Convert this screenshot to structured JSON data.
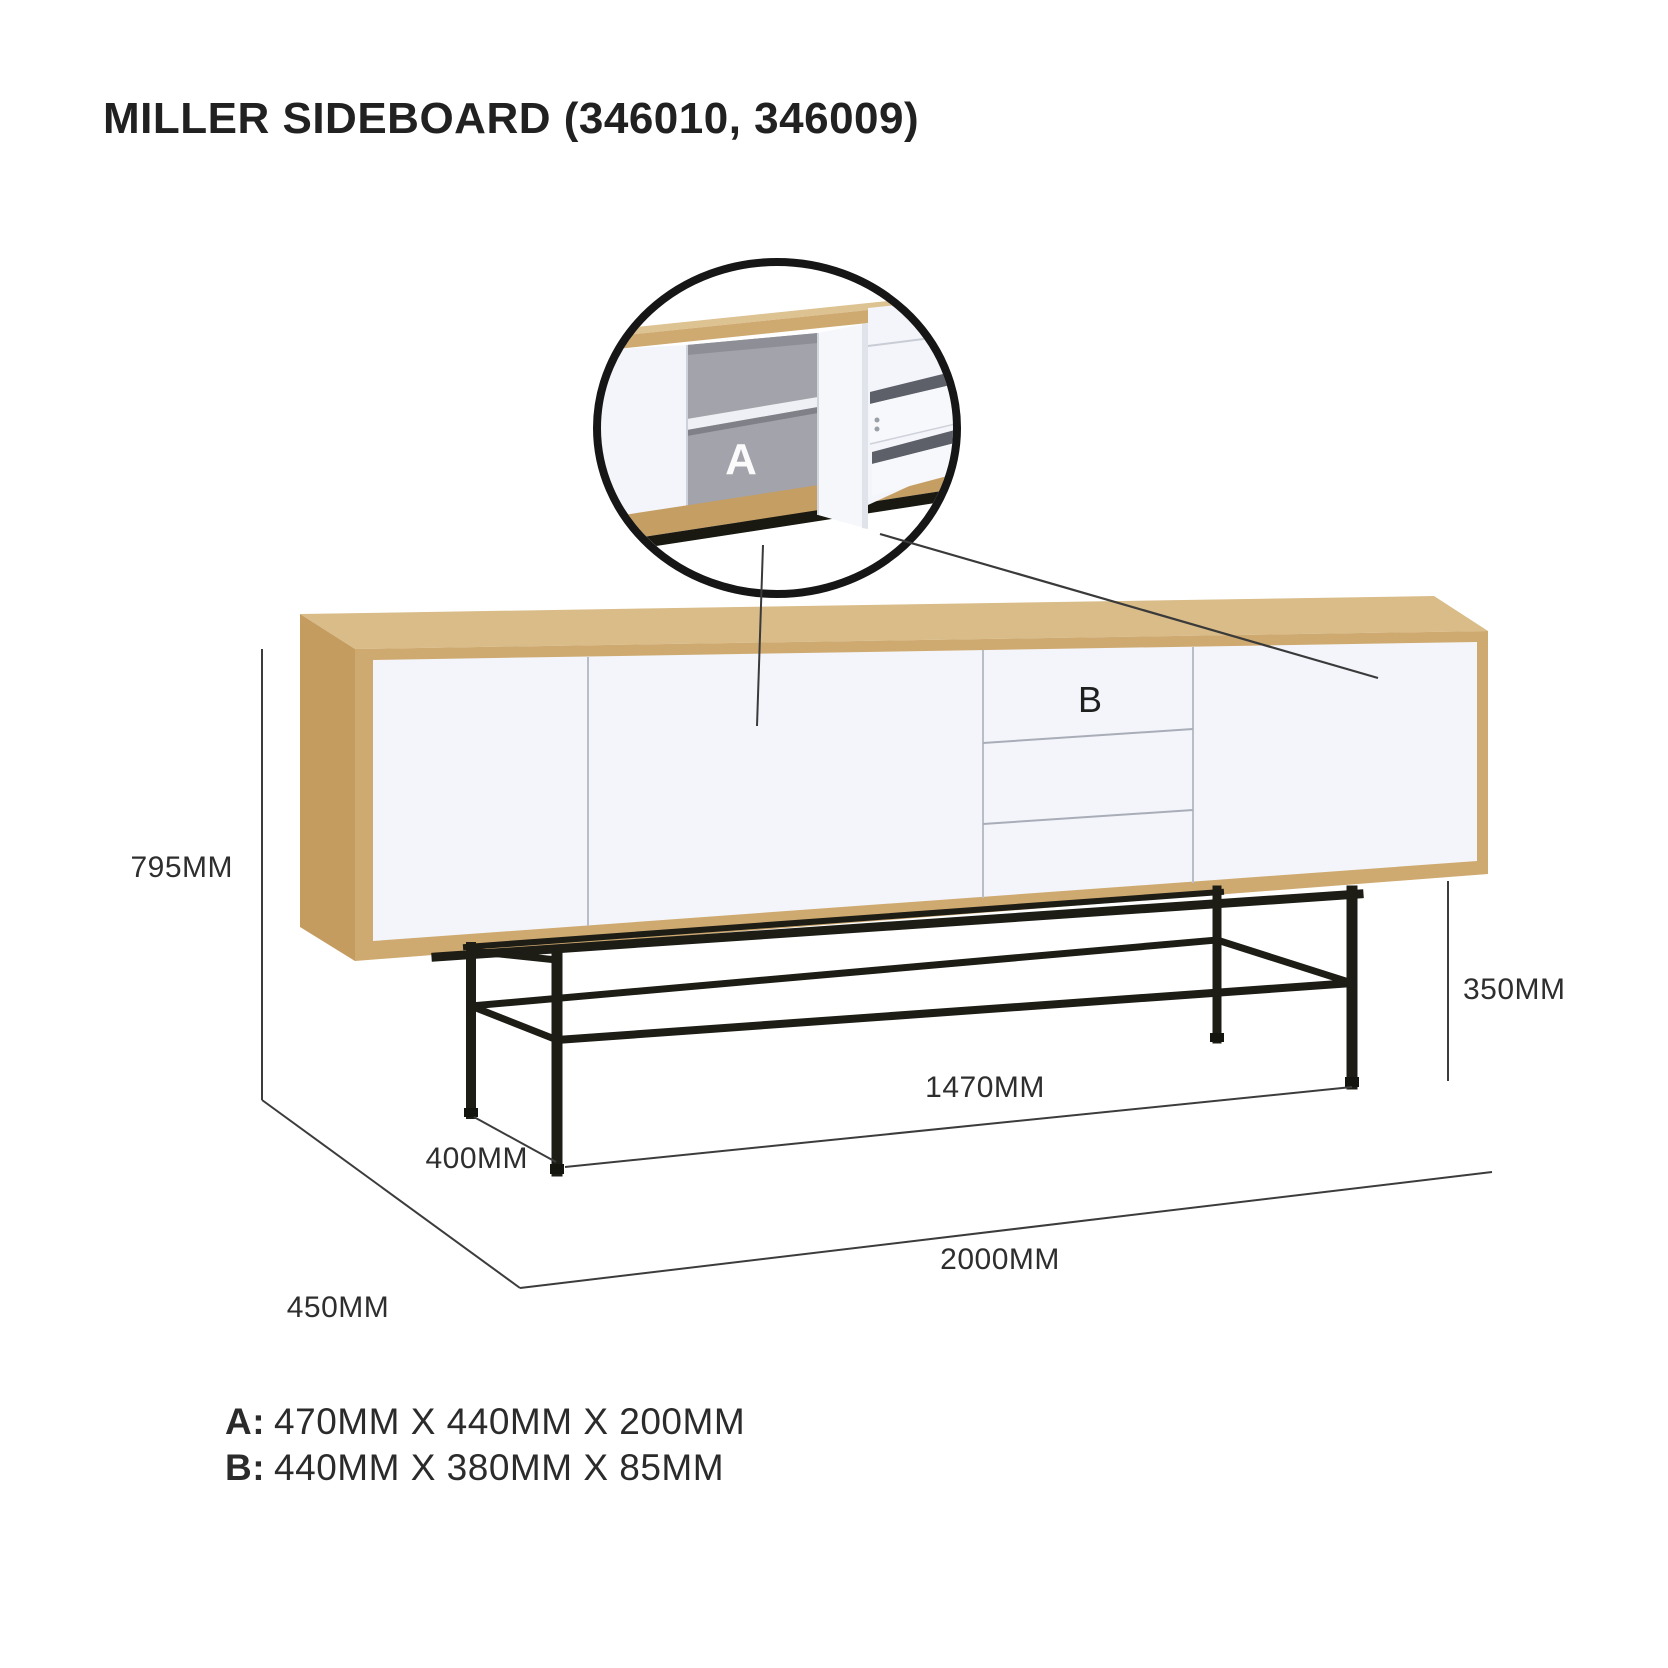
{
  "title": "MILLER SIDEBOARD (346010, 346009)",
  "callouts": {
    "a": "A",
    "b": "B"
  },
  "dims": {
    "height": "795MM",
    "leg_height": "350MM",
    "frame_width": "1470MM",
    "leg_depth": "400MM",
    "depth": "450MM",
    "width": "2000MM"
  },
  "specs": [
    {
      "label": "A:",
      "value": "470MM X 440MM X 200MM"
    },
    {
      "label": "B:",
      "value": "440MM X 380MM X 85MM"
    }
  ],
  "colors": {
    "wood_top": "#d9bc88",
    "wood_side": "#c49c60",
    "wood_front": "#cfaa70",
    "door_white": "#f3f5fa",
    "interior_gray": "#a2a3ab",
    "metal_black": "#1d1d16",
    "dim_line": "#3c3c3c",
    "text": "#212121"
  }
}
